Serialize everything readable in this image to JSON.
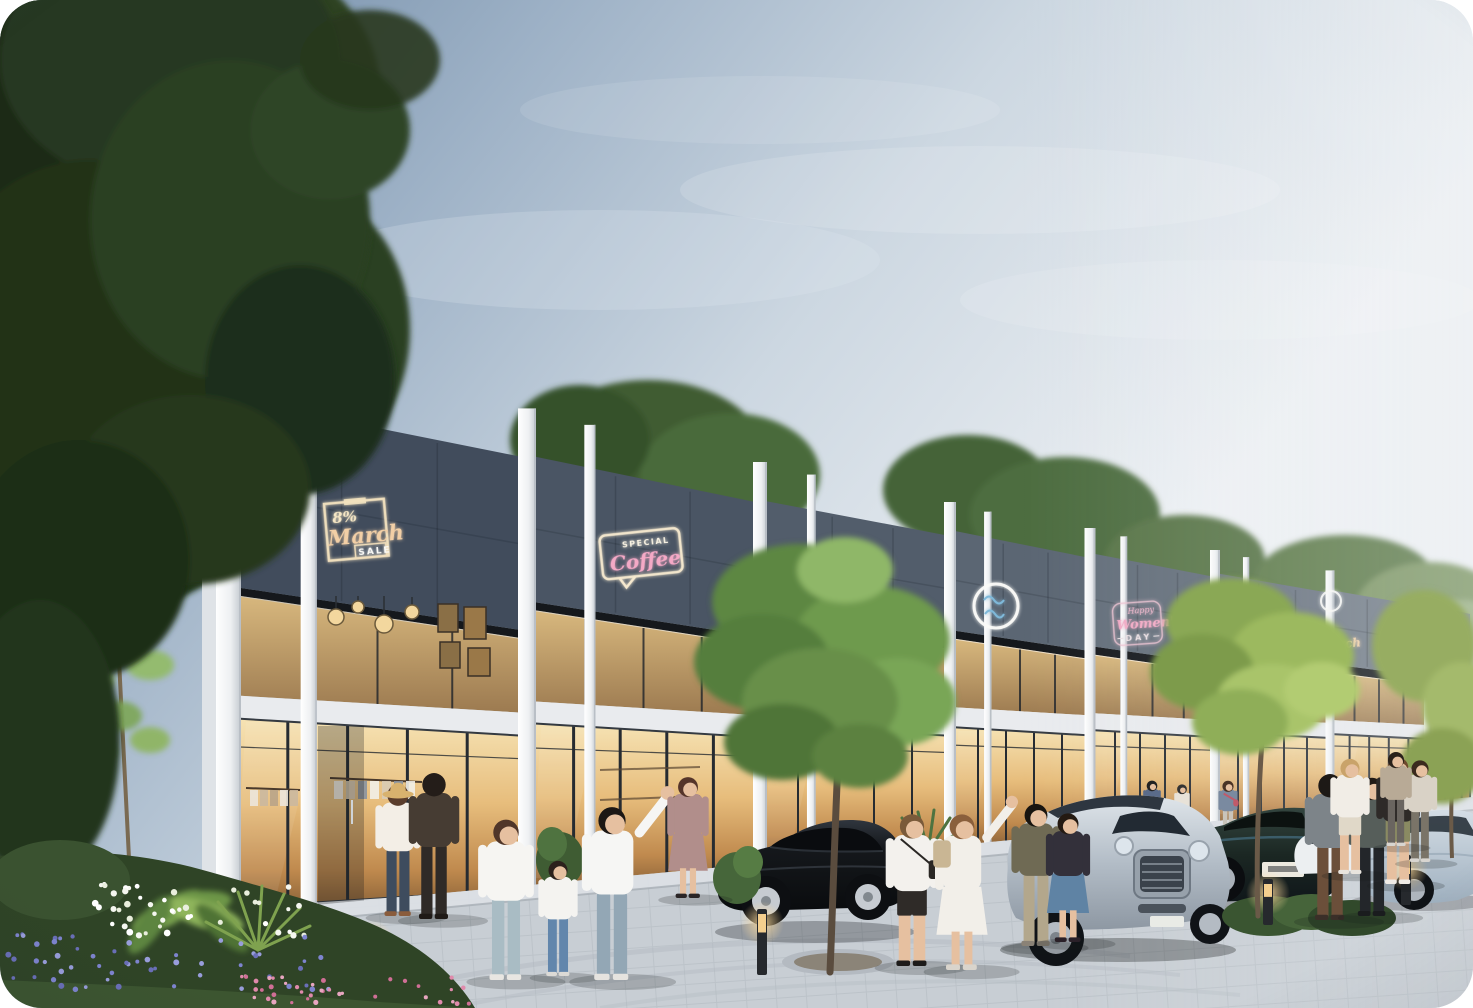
{
  "signs": {
    "march_sale": {
      "percent": "8%",
      "name": "March",
      "tag": "SALE"
    },
    "coffee": {
      "label": "SPECIAL",
      "name": "Coffee"
    },
    "boutique_partial": {
      "letters": "IC"
    },
    "womens_day": {
      "prefix": "Happy",
      "name": "Women's",
      "suffix": "DAY"
    },
    "march_far": {
      "name": "March"
    }
  },
  "colors": {
    "sky_top": "#66829f",
    "sky_light": "#eef1f4",
    "facade_dark": "#414c5c",
    "facade_fin": "#f2f3f4",
    "glass_warm": "#e7bd7c",
    "neon_cream": "#f2e2bf",
    "neon_pink": "#f4a9c6",
    "neon_blue": "#7fb9da",
    "foliage": "#57803f",
    "pavement": "#c8ced4"
  }
}
